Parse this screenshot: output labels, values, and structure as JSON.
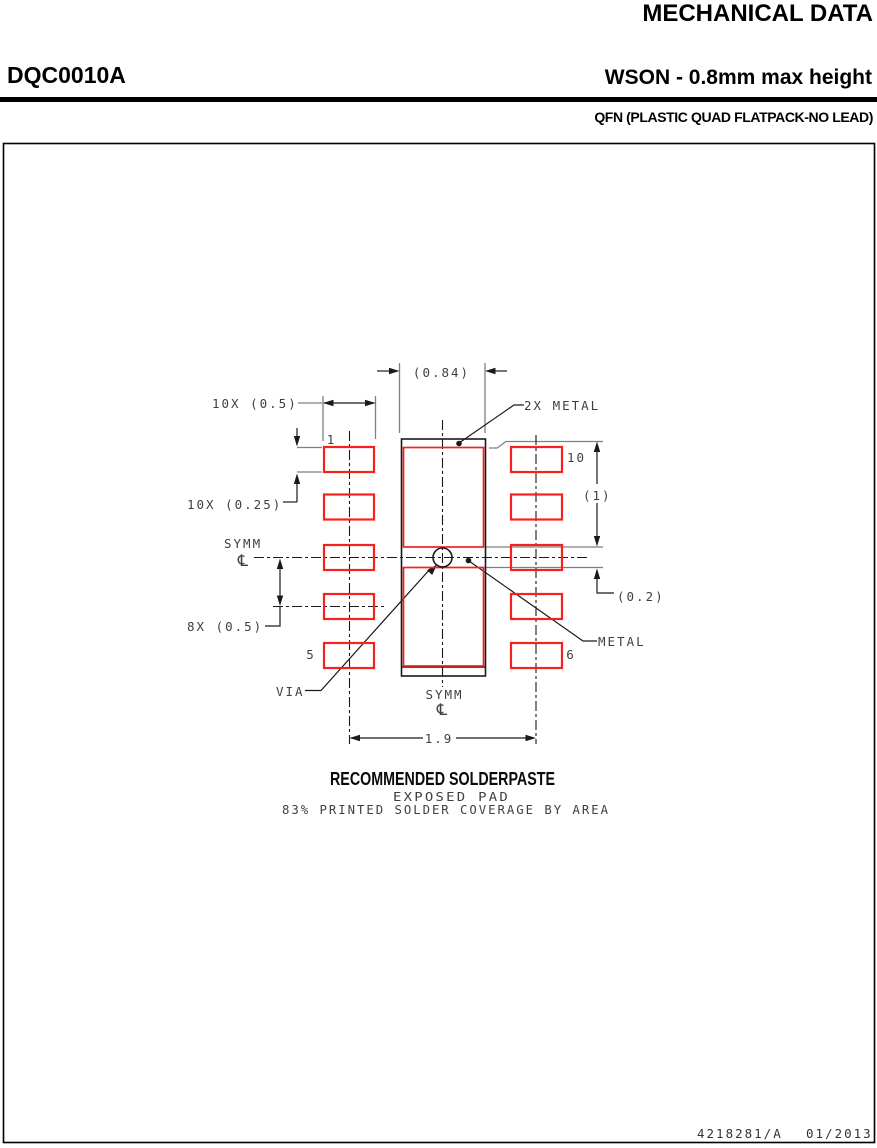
{
  "header": {
    "title": "MECHANICAL DATA",
    "part_number": "DQC0010A",
    "package_title": "WSON - 0.8mm max height",
    "package_subtitle": "QFN (PLASTIC QUAD FLATPACK-NO LEAD)"
  },
  "drawing": {
    "dimensions": {
      "paste_width": "(0.84)",
      "pad_width_10x": "10X (0.5)",
      "pad_height_10x": "10X (0.25)",
      "pitch_8x": "8X (0.5)",
      "metal_span": "(1)",
      "metal_strip": "(0.2)",
      "row_span": "1.9"
    },
    "labels": {
      "metal_2x": "2X METAL",
      "metal": "METAL",
      "via": "VIA",
      "symm": "SYMM",
      "centerline": "℄",
      "pin_1": "1",
      "pin_5": "5",
      "pin_6": "6",
      "pin_10": "10"
    },
    "caption": {
      "title": "RECOMMENDED SOLDERPASTE",
      "subtitle1": "EXPOSED PAD",
      "subtitle2": "83% PRINTED SOLDER COVERAGE BY AREA"
    },
    "colors": {
      "pad_red": "#f5211d",
      "reference_gray": "#808080",
      "line_black": "#1a1a1a"
    }
  },
  "footer": {
    "document_number": "4218281/A",
    "revision_date": "01/2013"
  }
}
